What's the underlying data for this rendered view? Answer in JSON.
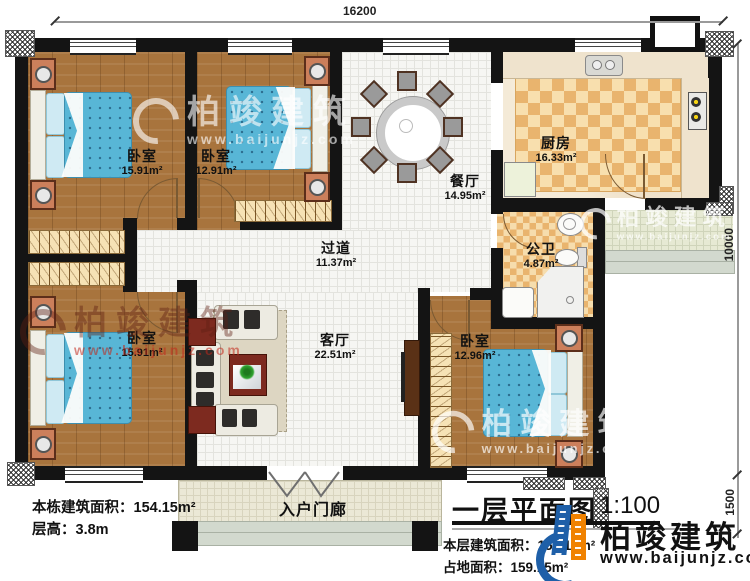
{
  "dimensions": {
    "top": "16200",
    "right_main": "10000",
    "right_porch": "1500"
  },
  "rooms": {
    "bedroom_tl": {
      "name": "卧室",
      "area": "15.91m²"
    },
    "bedroom_tm": {
      "name": "卧室",
      "area": "12.91m²"
    },
    "dining": {
      "name": "餐厅",
      "area": "14.95m²"
    },
    "kitchen": {
      "name": "厨房",
      "area": "16.33m²"
    },
    "bathroom": {
      "name": "公卫",
      "area": "4.87m²"
    },
    "corridor": {
      "name": "过道",
      "area": "11.37m²"
    },
    "living": {
      "name": "客厅",
      "area": "22.51m²"
    },
    "bedroom_bl": {
      "name": "卧室",
      "area": "15.91m²"
    },
    "bedroom_br": {
      "name": "卧室",
      "area": "12.96m²"
    },
    "porch": {
      "name": "入户门廊"
    }
  },
  "info_left": {
    "line1": "本栋建筑面积：154.15m²",
    "line2": "层高：3.8m"
  },
  "title_block": {
    "title": "一层平面图",
    "scale": "1:100",
    "line1": "本层建筑面积：154.15m²",
    "line2": "占地面积：159.15m²"
  },
  "brand": {
    "name": "柏竣建筑",
    "url": "www.baijunjz.com"
  },
  "watermark": {
    "name": "柏竣建筑",
    "url": "www.baijunjz.com"
  },
  "colors": {
    "wall": "#141414",
    "bed": "#58b6d6",
    "wood": "#a8743d",
    "brand_blue": "#1e5fa8",
    "brand_orange": "#f08200"
  }
}
